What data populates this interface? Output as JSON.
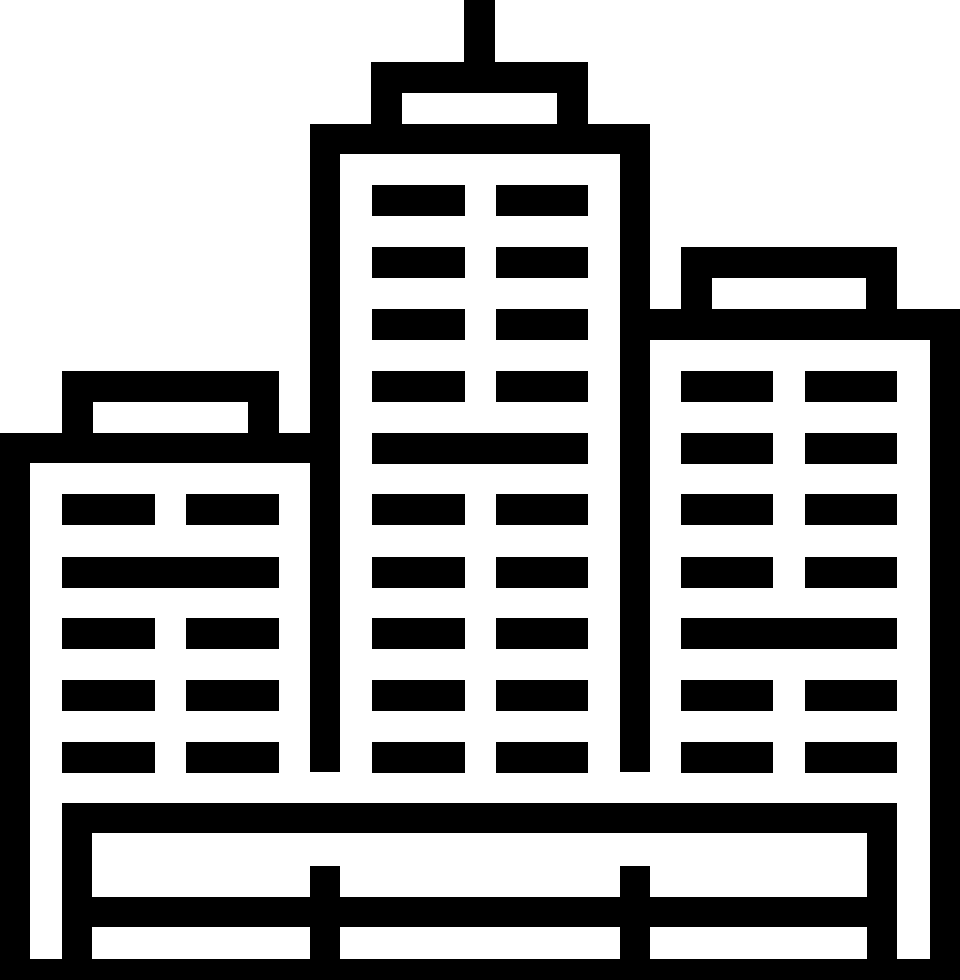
{
  "icon": {
    "name": "city-buildings-icon",
    "alt_text": "Black pictogram of three skyscrapers with slatted windows, a rooftop antenna on the tall center tower, rooftop penthouse boxes on each building, and a fenced base platform",
    "foreground_color": "#000000",
    "background_color": "#ffffff",
    "viewbox": "0 0 960 980",
    "groups": {
      "antenna": [
        [
          464,
          0,
          31,
          62
        ]
      ],
      "center-building-roof-box": [
        [
          371,
          62,
          217,
          31
        ],
        [
          371,
          93,
          31,
          31
        ],
        [
          557,
          93,
          31,
          31
        ]
      ],
      "center-building-frame": [
        [
          310,
          124,
          340,
          30
        ],
        [
          310,
          154,
          30,
          618
        ],
        [
          620,
          154,
          30,
          618
        ]
      ],
      "center-building-windows": [
        [
          372,
          185,
          93,
          31
        ],
        [
          496,
          185,
          92,
          31
        ],
        [
          372,
          247,
          93,
          31
        ],
        [
          496,
          247,
          92,
          31
        ],
        [
          372,
          309,
          93,
          31
        ],
        [
          496,
          309,
          92,
          31
        ],
        [
          372,
          371,
          93,
          31
        ],
        [
          496,
          371,
          92,
          31
        ],
        [
          372,
          433,
          216,
          31
        ],
        [
          372,
          494,
          93,
          31
        ],
        [
          496,
          494,
          92,
          31
        ],
        [
          372,
          557,
          93,
          31
        ],
        [
          496,
          557,
          92,
          31
        ],
        [
          372,
          618,
          93,
          31
        ],
        [
          496,
          618,
          92,
          31
        ],
        [
          372,
          680,
          93,
          31
        ],
        [
          496,
          680,
          92,
          31
        ],
        [
          372,
          742,
          93,
          31
        ],
        [
          496,
          742,
          92,
          31
        ]
      ],
      "left-building-roof-box": [
        [
          62,
          371,
          217,
          31
        ],
        [
          62,
          402,
          31,
          31
        ],
        [
          248,
          402,
          31,
          31
        ]
      ],
      "left-building-frame": [
        [
          0,
          433,
          310,
          30
        ],
        [
          0,
          463,
          30,
          517
        ]
      ],
      "left-building-windows": [
        [
          62,
          494,
          93,
          31
        ],
        [
          186,
          494,
          93,
          31
        ],
        [
          62,
          557,
          217,
          31
        ],
        [
          62,
          618,
          93,
          31
        ],
        [
          186,
          618,
          93,
          31
        ],
        [
          62,
          680,
          93,
          31
        ],
        [
          186,
          680,
          93,
          31
        ],
        [
          62,
          742,
          93,
          31
        ],
        [
          186,
          742,
          93,
          31
        ]
      ],
      "right-building-roof-box": [
        [
          681,
          247,
          216,
          31
        ],
        [
          681,
          278,
          31,
          31
        ],
        [
          866,
          278,
          31,
          31
        ]
      ],
      "right-building-frame": [
        [
          650,
          309,
          310,
          31
        ],
        [
          930,
          340,
          30,
          640
        ]
      ],
      "right-building-windows": [
        [
          681,
          371,
          92,
          31
        ],
        [
          805,
          371,
          92,
          31
        ],
        [
          681,
          433,
          92,
          31
        ],
        [
          805,
          433,
          92,
          31
        ],
        [
          681,
          494,
          92,
          31
        ],
        [
          805,
          494,
          92,
          31
        ],
        [
          681,
          557,
          92,
          31
        ],
        [
          805,
          557,
          92,
          31
        ],
        [
          681,
          618,
          216,
          31
        ],
        [
          681,
          680,
          92,
          31
        ],
        [
          805,
          680,
          92,
          31
        ],
        [
          681,
          742,
          92,
          31
        ],
        [
          805,
          742,
          92,
          31
        ]
      ],
      "base-fence": [
        [
          62,
          803,
          835,
          30
        ],
        [
          62,
          833,
          30,
          147
        ],
        [
          867,
          833,
          30,
          147
        ],
        [
          92,
          897,
          775,
          30
        ],
        [
          310,
          866,
          30,
          114
        ],
        [
          620,
          866,
          30,
          114
        ],
        [
          0,
          959,
          960,
          21
        ]
      ]
    }
  }
}
